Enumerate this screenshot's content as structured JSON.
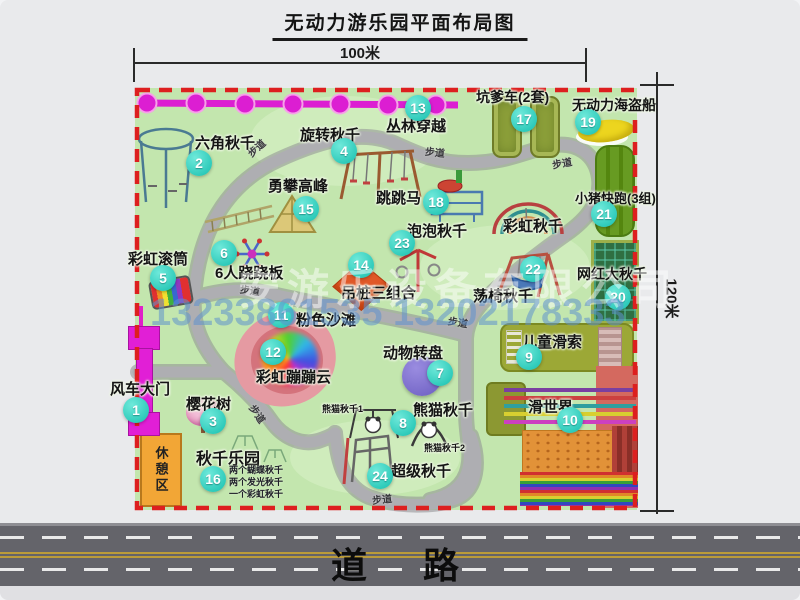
{
  "title": "无动力游乐园平面布局图",
  "dim_top": "100米",
  "dim_right": "120米",
  "road_label": "道　路",
  "walkway": "步道",
  "rest_area": "休憩区",
  "rainbow_swing_label": "彩虹秋千",
  "watermark": {
    "company": "安游乐设备有限公司",
    "phones": "13233861535 13202178333"
  },
  "attractions": {
    "a1": {
      "num": "1",
      "label": "风车大门"
    },
    "a2": {
      "num": "2",
      "label": "六角秋千"
    },
    "a3": {
      "num": "3",
      "label": "樱花树"
    },
    "a4": {
      "num": "4",
      "label": "旋转秋千"
    },
    "a5": {
      "num": "5",
      "label": "彩虹滚筒"
    },
    "a6": {
      "num": "6",
      "label": "6人跷跷板"
    },
    "a7": {
      "num": "7",
      "label": "动物转盘"
    },
    "a8": {
      "num": "8",
      "label": "熊猫秋千"
    },
    "a9": {
      "num": "9",
      "label": "儿童滑索"
    },
    "a10": {
      "num": "10",
      "label": "滑世界"
    },
    "a11": {
      "num": "11",
      "label": "粉色沙滩"
    },
    "a12": {
      "num": "12",
      "label": "彩虹蹦蹦云"
    },
    "a13": {
      "num": "13",
      "label": "丛林穿越"
    },
    "a14": {
      "num": "14",
      "label": "吊桩三组合"
    },
    "a15": {
      "num": "15",
      "label": "勇攀高峰"
    },
    "a16": {
      "num": "16",
      "label": "秋千乐园"
    },
    "a17": {
      "num": "17",
      "label": "坑爹车(2套)"
    },
    "a18": {
      "num": "18",
      "label": "跳跳马"
    },
    "a19": {
      "num": "19",
      "label": "无动力海盗船"
    },
    "a20": {
      "num": "20",
      "label": "网红大秋千"
    },
    "a21": {
      "num": "21",
      "label": "小猪快跑(3组)"
    },
    "a22": {
      "num": "22",
      "label": "荡椅秋千"
    },
    "a23": {
      "num": "23",
      "label": "泡泡秋千"
    },
    "a24": {
      "num": "24",
      "label": "超级秋千"
    }
  },
  "panda_sub1": "熊猫秋千1",
  "panda_sub2": "熊猫秋千2",
  "swing_park_details": [
    "两个蝴蝶秋千",
    "两个发光秋千",
    "一个彩虹秋千"
  ]
}
